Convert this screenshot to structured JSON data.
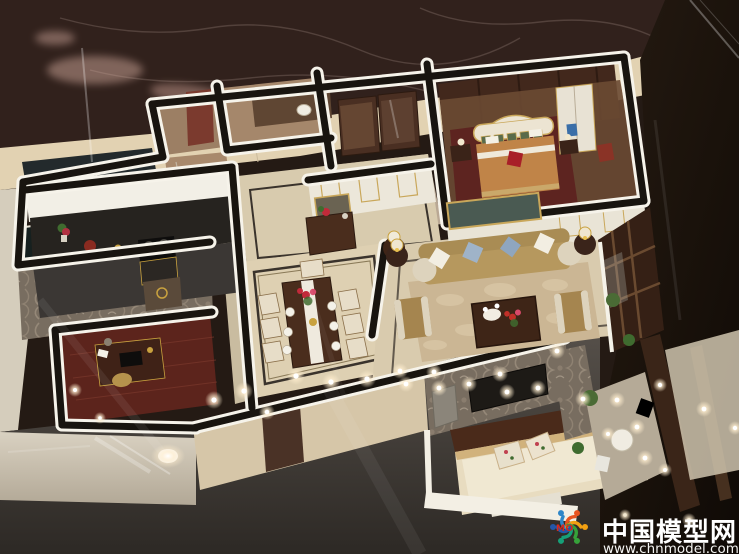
{
  "image": {
    "description": "Photograph of an illuminated architectural scale model (miniature) of an apartment interior, viewed from above at an angle, displayed under glass on a dark marble surface",
    "width_px": 739,
    "height_px": 554
  },
  "watermark": {
    "site_name": "中国模型网",
    "site_url": "www.chnmodel.com",
    "logo_text": "MO"
  },
  "scene_regions": [
    "master-bedroom",
    "walk-in-closet",
    "toilet-room",
    "shower-bathroom",
    "kitchen",
    "service-balcony",
    "study",
    "hallway-console",
    "dining-room",
    "living-room",
    "balcony-right",
    "second-bedroom",
    "terrace-bottom-right"
  ],
  "palette": {
    "marble_dark": "#31211c",
    "ledge_beige": "#e2d2b2",
    "wall_edge_white": "#f6f3ea",
    "wall_top_black": "#18140f",
    "floor_cream": "#d9cbae",
    "wood_dark": "#4a2d1d",
    "sofa_tan": "#b6985e",
    "bed_orange": "#c08448",
    "accent_red": "#a81f28",
    "damask_grey": "#786d60",
    "glass_black": "#171009",
    "plant_green": "#4a6b35",
    "gold_trim": "#c9a75a"
  }
}
